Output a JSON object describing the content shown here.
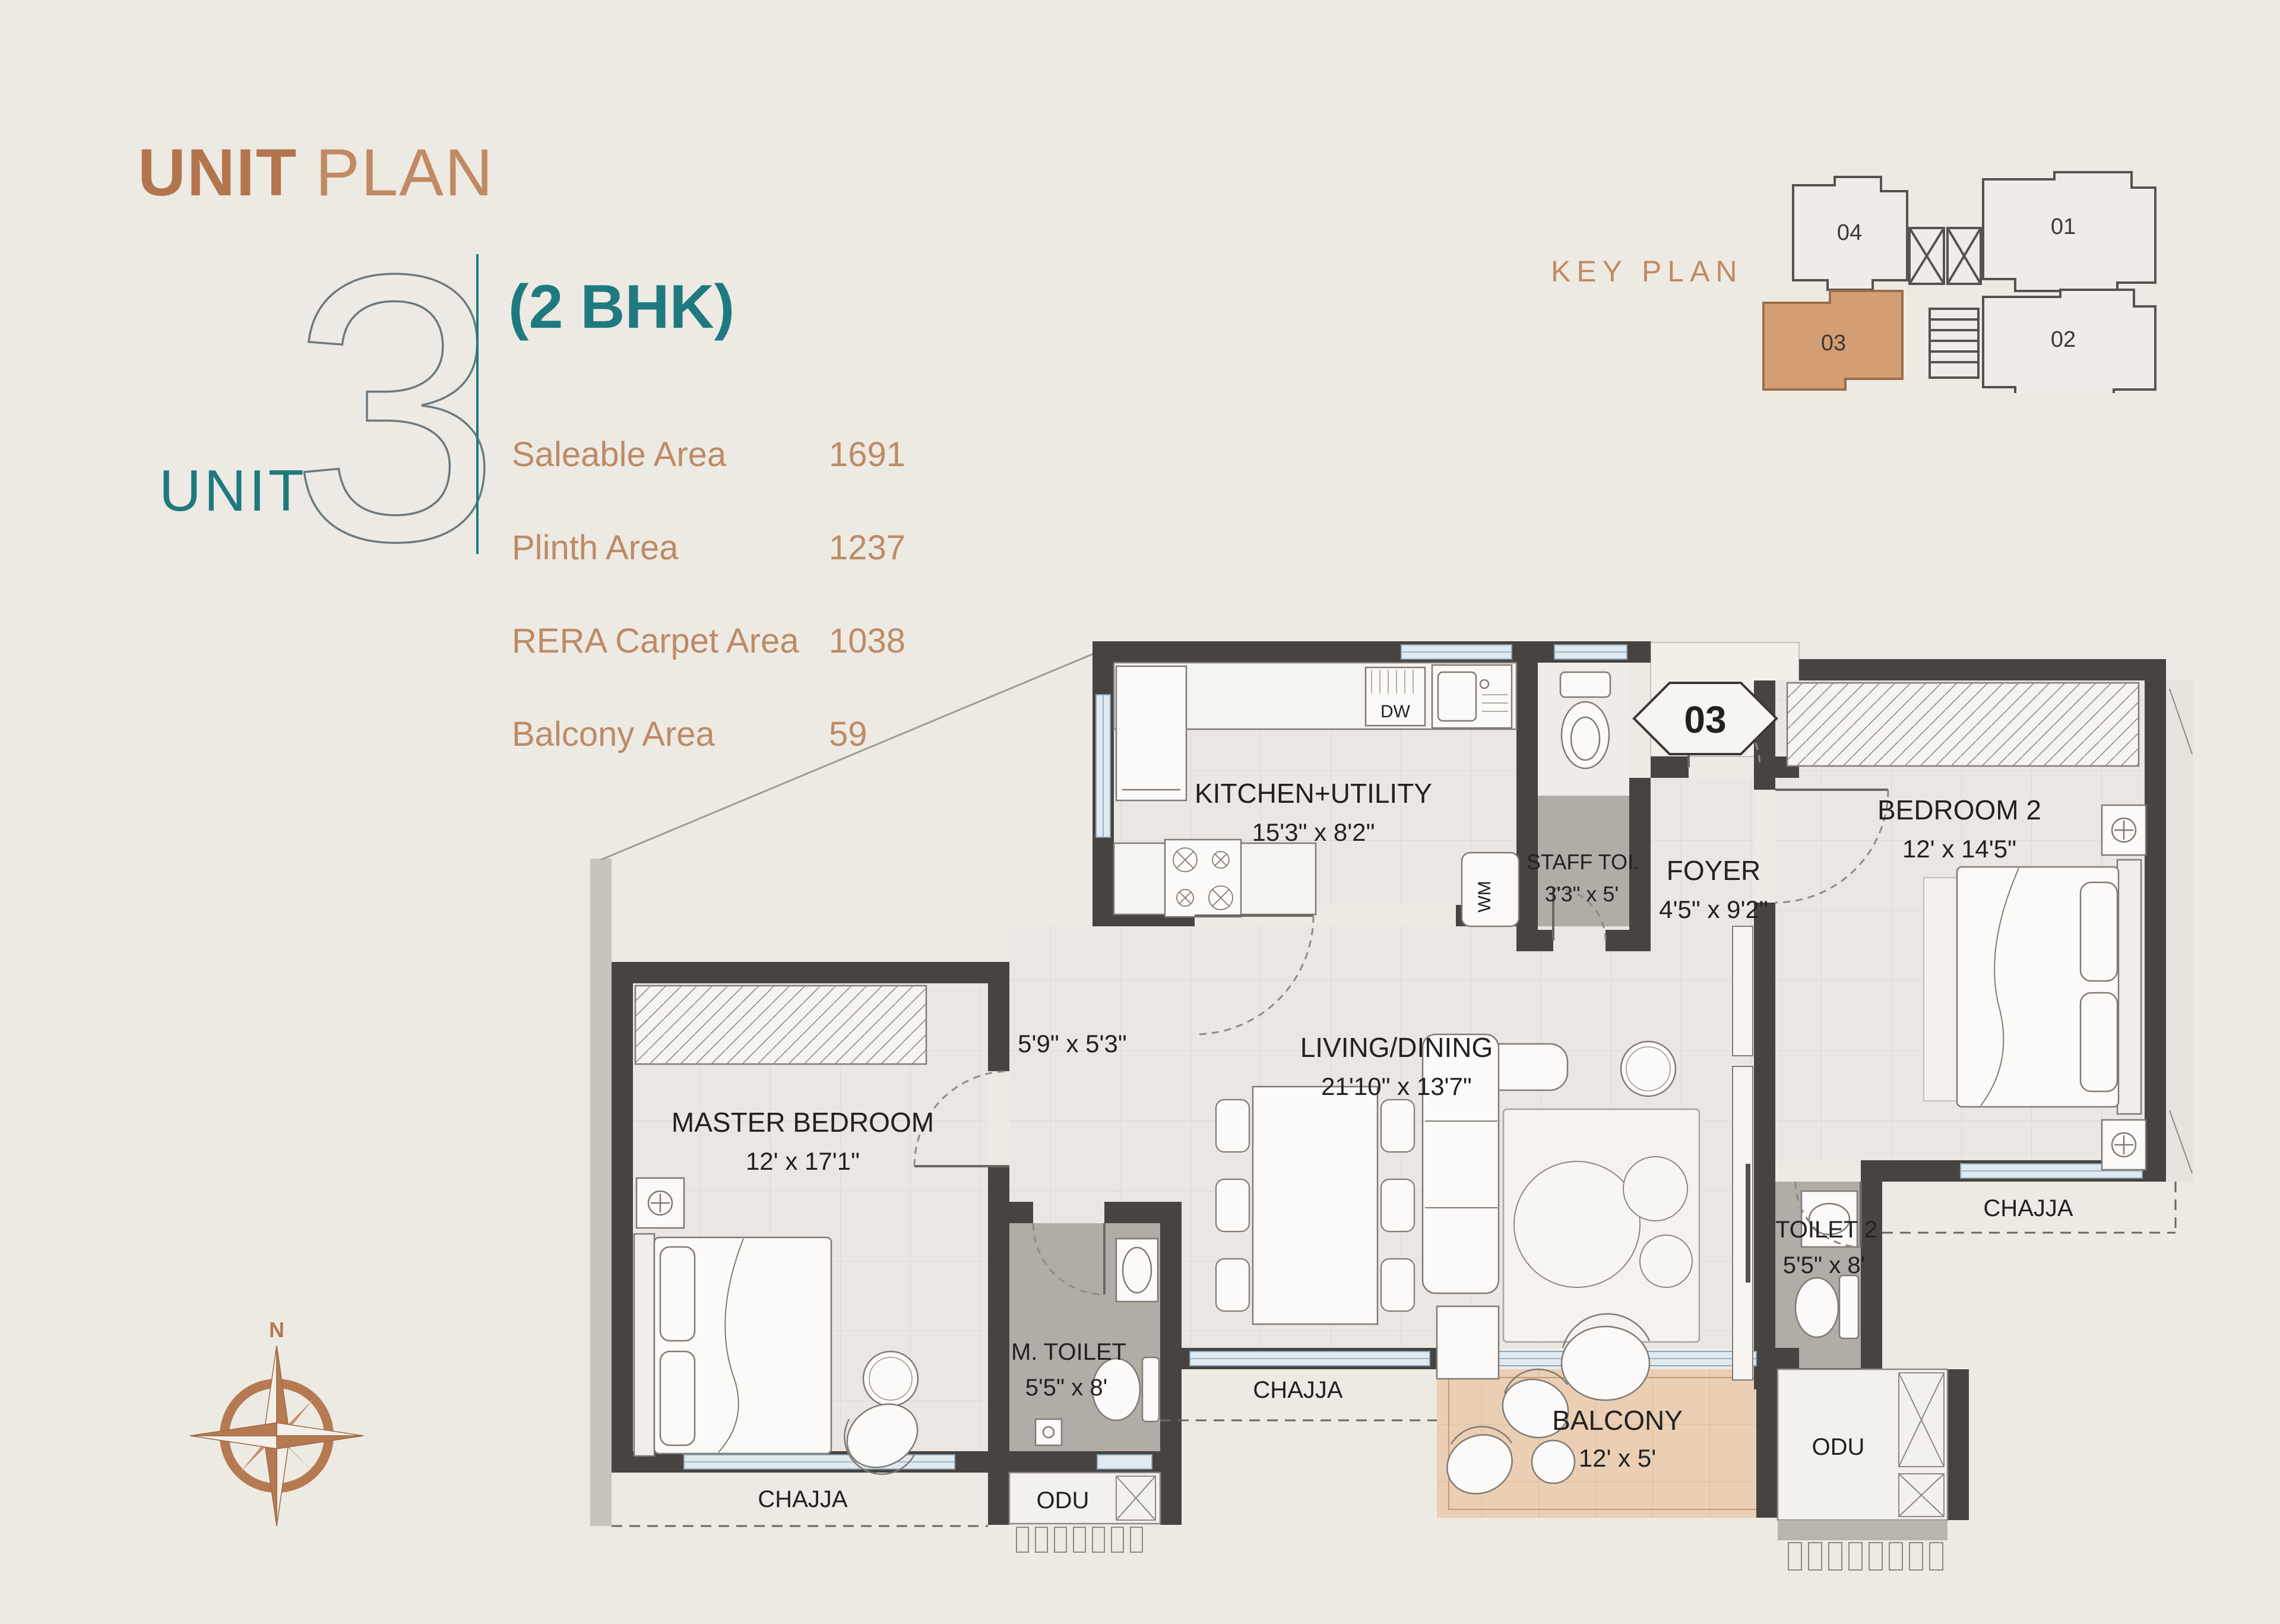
{
  "page": {
    "background": "#edeae4",
    "accent_copper": "#b3754e",
    "accent_teal": "#1f7a80"
  },
  "header": {
    "title_bold": "UNIT",
    "title_light": "PLAN"
  },
  "unit": {
    "label": "UNIT",
    "number": "3",
    "type": "(2 BHK)",
    "areas": [
      {
        "label": "Saleable Area",
        "value": "1691"
      },
      {
        "label": "Plinth Area",
        "value": "1237"
      },
      {
        "label": "RERA Carpet Area",
        "value": "1038"
      },
      {
        "label": "Balcony Area",
        "value": "59"
      }
    ]
  },
  "key_plan": {
    "title": "KEY PLAN",
    "highlight_color": "#d39e73",
    "units": [
      {
        "id": "04"
      },
      {
        "id": "01"
      },
      {
        "id": "03",
        "highlighted": true
      },
      {
        "id": "02"
      }
    ]
  },
  "plan": {
    "unit_marker": "03",
    "rooms": {
      "kitchen": {
        "name": "KITCHEN+UTILITY",
        "dims": "15'3\" x 8'2\""
      },
      "staff_toilet": {
        "name": "STAFF TOI.",
        "dims": "3'3\" x 5'"
      },
      "foyer": {
        "name": "FOYER",
        "dims": "4'5\" x 9'2\""
      },
      "bedroom2": {
        "name": "BEDROOM 2",
        "dims": "12' x 14'5\""
      },
      "living": {
        "name": "LIVING/DINING",
        "dims": "21'10\" x 13'7\""
      },
      "master": {
        "name": "MASTER BEDROOM",
        "dims": "12' x 17'1\""
      },
      "passage": {
        "dims": "5'9\" x 5'3\""
      },
      "m_toilet": {
        "name": "M. TOILET",
        "dims": "5'5\" x 8'"
      },
      "toilet2": {
        "name": "TOILET 2",
        "dims": "5'5\" x 8'"
      },
      "balcony": {
        "name": "BALCONY",
        "dims": "12' x 5'"
      }
    },
    "annotations": {
      "chajja": "CHAJJA",
      "odu": "ODU",
      "dw": "DW",
      "wm": "WM",
      "north": "N"
    }
  }
}
